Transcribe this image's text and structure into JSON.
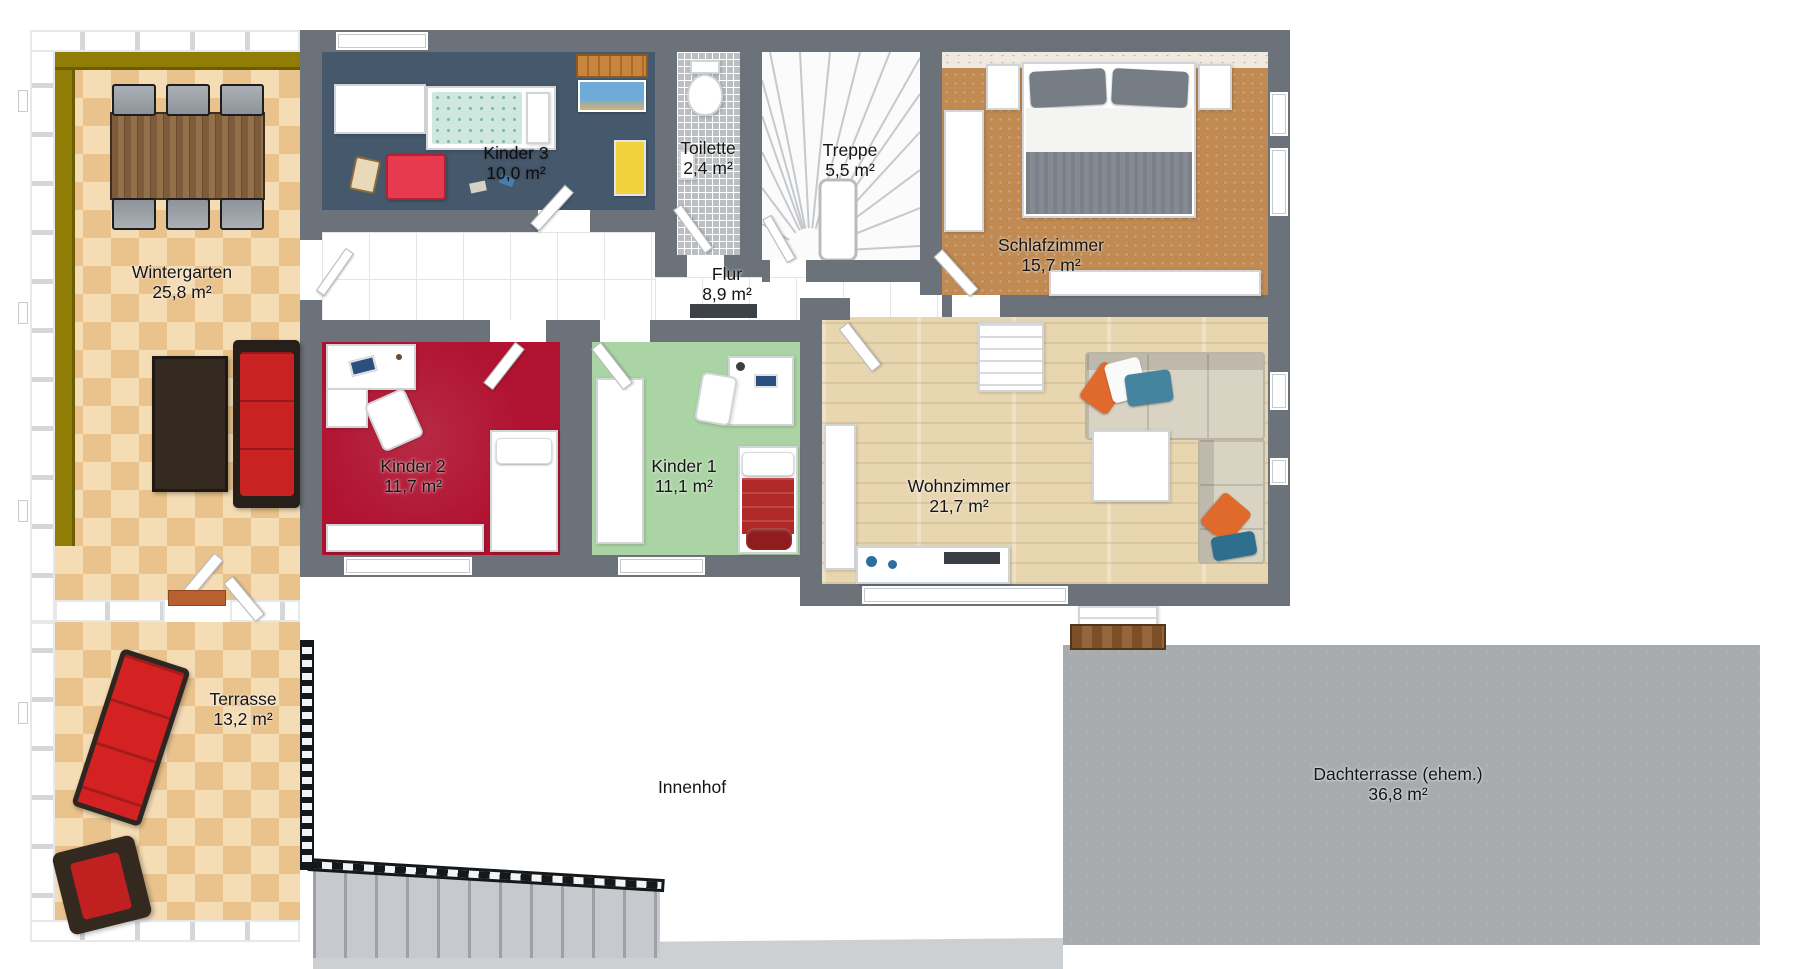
{
  "plan_title": "Floor plan with room areas",
  "rooms": [
    {
      "id": "wintergarten",
      "name": "Wintergarten",
      "area": "25,8 m²"
    },
    {
      "id": "kinder3",
      "name": "Kinder 3",
      "area": "10,0 m²"
    },
    {
      "id": "toilette",
      "name": "Toilette",
      "area": "2,4 m²"
    },
    {
      "id": "treppe",
      "name": "Treppe",
      "area": "5,5 m²"
    },
    {
      "id": "schlafzimmer",
      "name": "Schlafzimmer",
      "area": "15,7 m²"
    },
    {
      "id": "flur",
      "name": "Flur",
      "area": "8,9 m²"
    },
    {
      "id": "kinder2",
      "name": "Kinder 2",
      "area": "11,7 m²"
    },
    {
      "id": "kinder1",
      "name": "Kinder 1",
      "area": "11,1 m²"
    },
    {
      "id": "wohnzimmer",
      "name": "Wohnzimmer",
      "area": "21,7 m²"
    },
    {
      "id": "terrasse",
      "name": "Terrasse",
      "area": "13,2 m²"
    },
    {
      "id": "innenhof",
      "name": "Innenhof",
      "area": ""
    },
    {
      "id": "dachterrasse",
      "name": "Dachterrasse (ehem.)",
      "area": "36,8 m²"
    }
  ],
  "colors": {
    "wall": "#6c727a",
    "tileA": "#f4dcb4",
    "tileB": "#e9c28c",
    "olive": "#907d06",
    "k3": "#46586c",
    "k2": "#b01230",
    "k1": "#abd4a4",
    "cork": "#c08a52",
    "wood": "#e8d6b0",
    "toilette": "#bcbfc1",
    "dach": "#a8abad",
    "sofa": "#d9d3c3",
    "red": "#c92222",
    "accent_orange": "#e06a2c",
    "accent_blue": "#44849f",
    "yellow": "#f1d13c"
  }
}
